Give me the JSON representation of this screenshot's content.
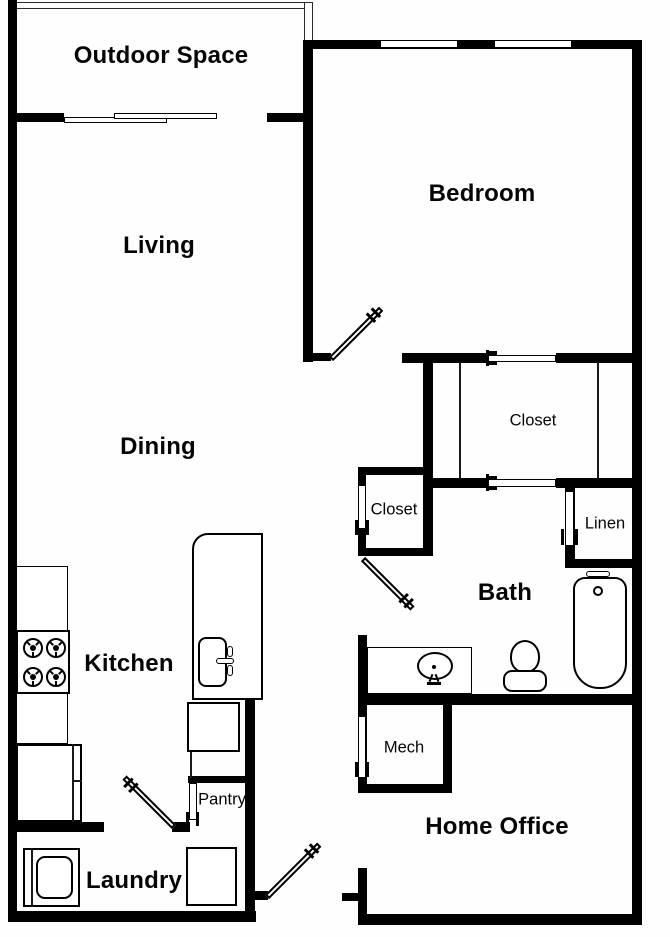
{
  "plan": {
    "type": "floor-plan",
    "background_color": "#ffffff",
    "wall_color": "#000000",
    "rooms": {
      "outdoor_space": {
        "label": "Outdoor Space"
      },
      "living": {
        "label": "Living"
      },
      "bedroom": {
        "label": "Bedroom"
      },
      "dining": {
        "label": "Dining"
      },
      "walk_in_closet": {
        "label": "Closet"
      },
      "hall_closet": {
        "label": "Closet"
      },
      "linen": {
        "label": "Linen"
      },
      "bath": {
        "label": "Bath"
      },
      "kitchen": {
        "label": "Kitchen"
      },
      "mech": {
        "label": "Mech"
      },
      "pantry": {
        "label": "Pantry"
      },
      "home_office": {
        "label": "Home Office"
      },
      "laundry": {
        "label": "Laundry"
      }
    },
    "fixtures": [
      "balcony-railing",
      "sliding-patio-door",
      "bedroom-windows",
      "kitchen-counter",
      "range-cooktop",
      "refrigerator",
      "kitchen-island",
      "island-sink",
      "island-faucet",
      "dishwasher",
      "washer",
      "dryer",
      "vanity",
      "vanity-sink",
      "toilet",
      "bathtub",
      "closet-sliding-doors",
      "pocket-doors",
      "hinged-doors"
    ]
  }
}
